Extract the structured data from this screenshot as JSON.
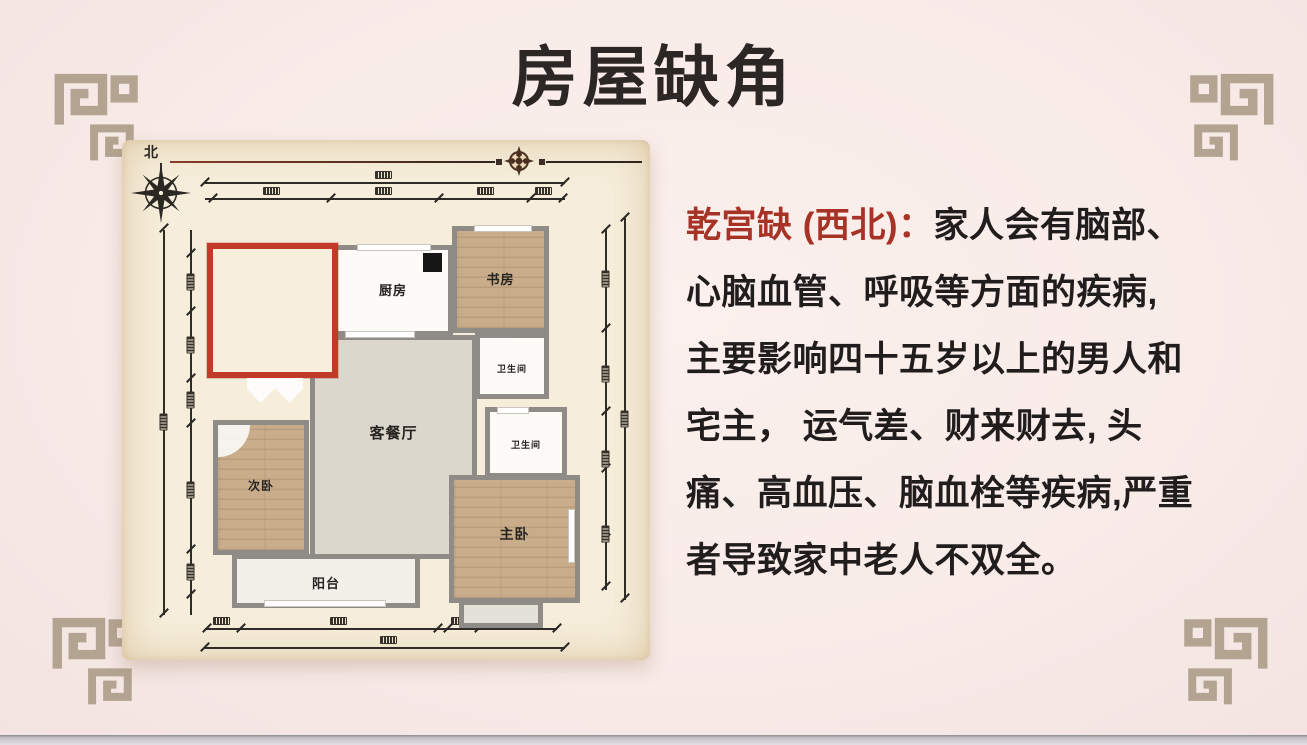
{
  "title": "房屋缺角",
  "description": {
    "lead": "乾宫缺 (西北)：",
    "lines": [
      "家人会有脑部、",
      "心脑血管、呼吸等方面的疾病,",
      "主要影响四十五岁以上的男人和",
      "宅主， 运气差、财来财去, 头",
      "痛、高血压、脑血栓等疾病,严重",
      "者导致家中老人不双全。"
    ]
  },
  "floorplan": {
    "compass_label": "北",
    "rooms": {
      "kitchen": "厨房",
      "study": "书房",
      "bathroom": "卫生间",
      "living": "客餐厅",
      "second_bedroom": "次卧",
      "master_bedroom": "主卧",
      "balcony": "阳台"
    }
  },
  "colors": {
    "background": "#f8ebe8",
    "title_text": "#2c2624",
    "accent_red_text": "#a73226",
    "missing_corner_border": "#c23a28",
    "panel_cream": "#f6eedb",
    "wall_grey": "#8f8c87",
    "ornament_taupe": "#b3a492"
  }
}
